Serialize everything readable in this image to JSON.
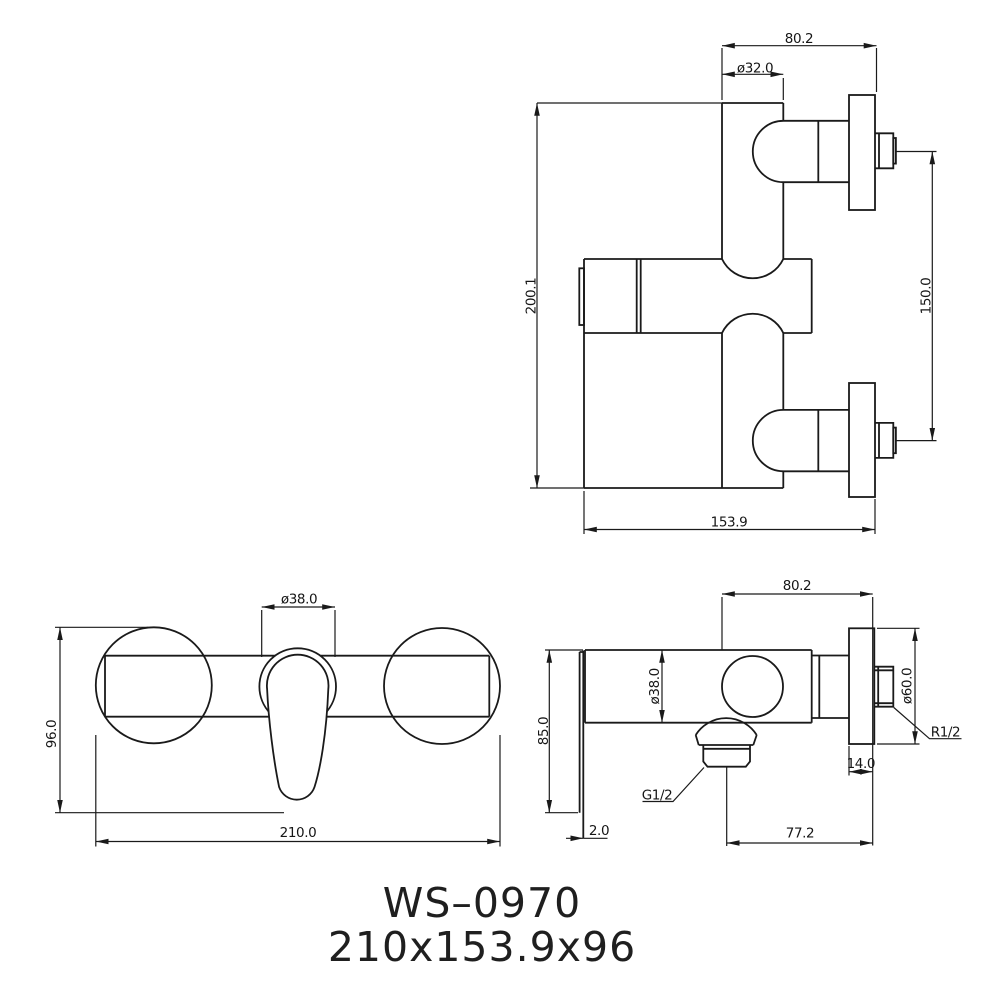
{
  "colors": {
    "ink": "#1a1a1a",
    "background": "#ffffff"
  },
  "title": {
    "model": "WS–0970",
    "overall_size": "210x153.9x96"
  },
  "views": {
    "top": {
      "dims": {
        "depth": "80.2",
        "body_diameter": "ø32.0",
        "overall_height": "200.1",
        "connection_spacing": "150.0",
        "overall_depth": "153.9"
      }
    },
    "front": {
      "dims": {
        "handle_diameter": "ø38.0",
        "height": "96.0",
        "width": "210.0"
      }
    },
    "side": {
      "dims": {
        "depth": "80.2",
        "body_diameter": "ø38.0",
        "plate_height": "85.0",
        "flange_diameter": "ø60.0",
        "flange_thickness": "14.0",
        "outlet_offset": "77.2",
        "plate_thickness": "2.0",
        "outlet_thread": "G1/2",
        "inlet_thread": "R1/2"
      }
    }
  }
}
